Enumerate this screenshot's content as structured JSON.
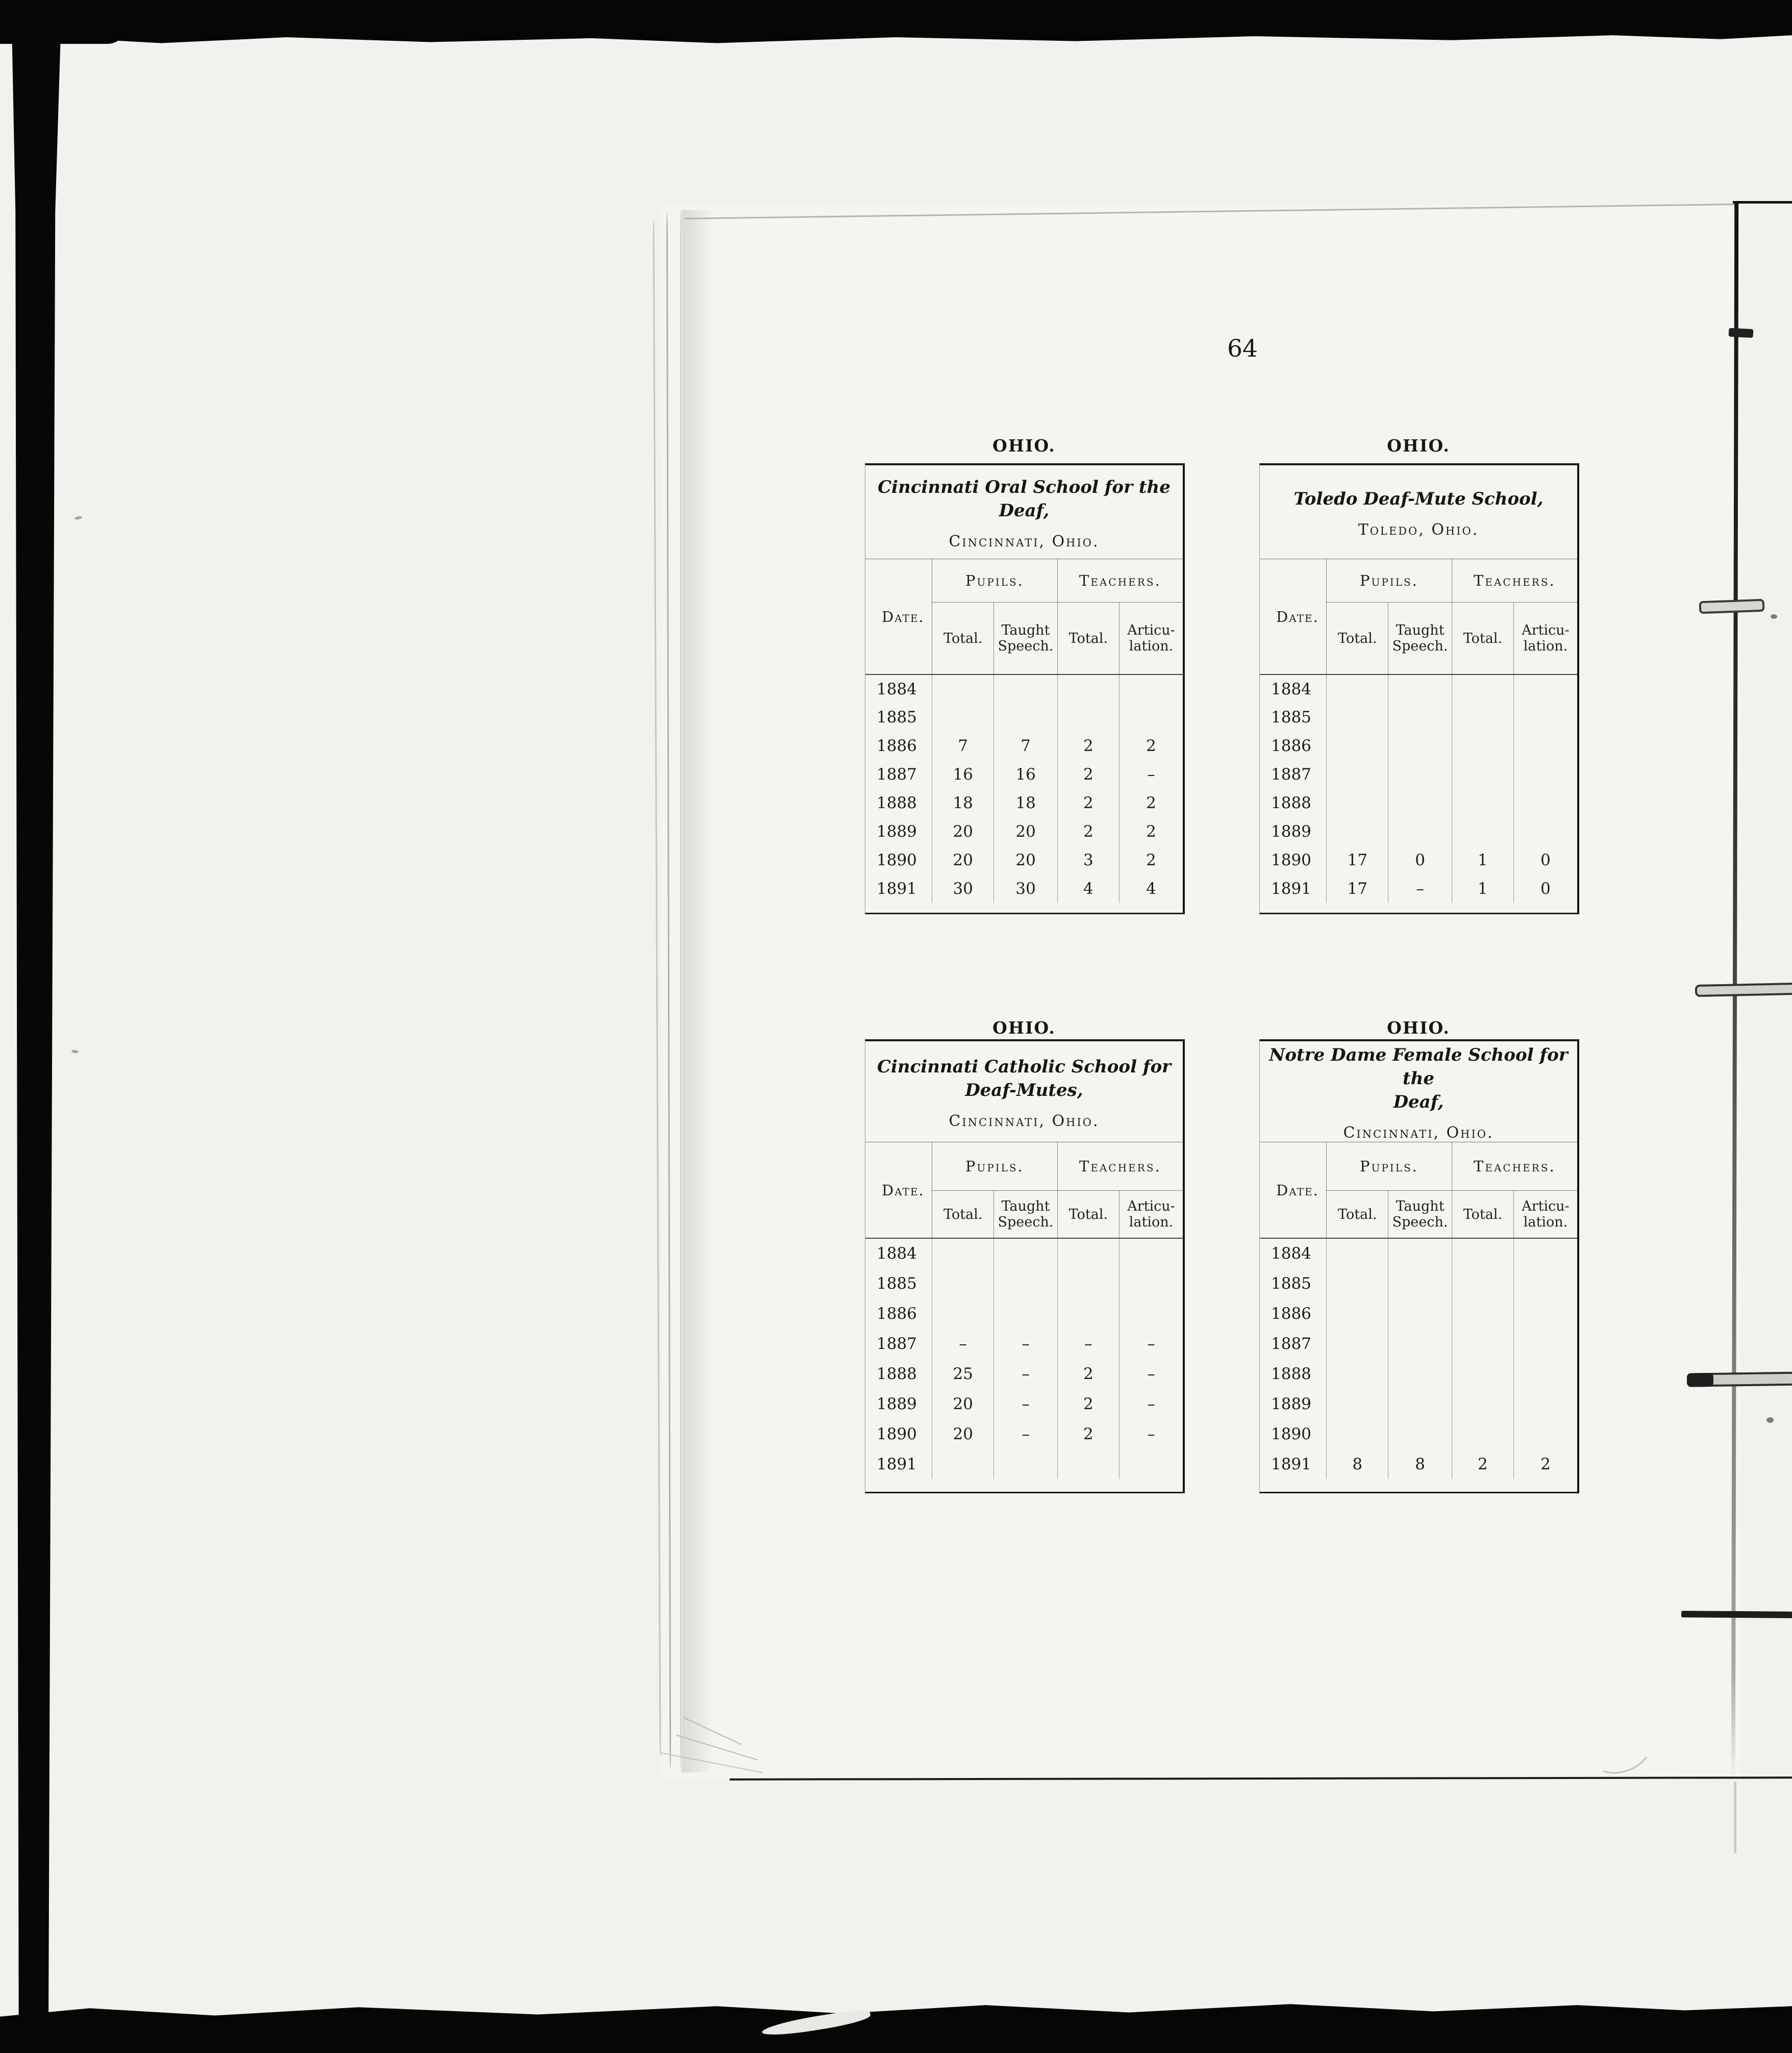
{
  "page": {
    "number": "64"
  },
  "headers": {
    "date": "Date.",
    "pupils": "Pupils.",
    "teachers": "Teachers.",
    "sub_columns": [
      "Total.",
      "Taught\nSpeech.",
      "Total.",
      "Articu-\nlation."
    ]
  },
  "tables": [
    {
      "region": "OHIO.",
      "title": "Cincinnati Oral School for the Deaf,",
      "location": "Cincinnati, Ohio.",
      "rows": [
        {
          "year": "1884",
          "values": [
            "",
            "",
            "",
            ""
          ]
        },
        {
          "year": "1885",
          "values": [
            "",
            "",
            "",
            ""
          ]
        },
        {
          "year": "1886",
          "values": [
            "7",
            "7",
            "2",
            "2"
          ]
        },
        {
          "year": "1887",
          "values": [
            "16",
            "16",
            "2",
            "–"
          ]
        },
        {
          "year": "1888",
          "values": [
            "18",
            "18",
            "2",
            "2"
          ]
        },
        {
          "year": "1889",
          "values": [
            "20",
            "20",
            "2",
            "2"
          ]
        },
        {
          "year": "1890",
          "values": [
            "20",
            "20",
            "3",
            "2"
          ]
        },
        {
          "year": "1891",
          "values": [
            "30",
            "30",
            "4",
            "4"
          ]
        }
      ]
    },
    {
      "region": "OHIO.",
      "title": "Toledo Deaf-Mute School,",
      "location": "Toledo, Ohio.",
      "rows": [
        {
          "year": "1884",
          "values": [
            "",
            "",
            "",
            ""
          ]
        },
        {
          "year": "1885",
          "values": [
            "",
            "",
            "",
            ""
          ]
        },
        {
          "year": "1886",
          "values": [
            "",
            "",
            "",
            ""
          ]
        },
        {
          "year": "1887",
          "values": [
            "",
            "",
            "",
            ""
          ]
        },
        {
          "year": "1888",
          "values": [
            "",
            "",
            "",
            ""
          ]
        },
        {
          "year": "1889",
          "values": [
            "",
            "",
            "",
            ""
          ]
        },
        {
          "year": "1890",
          "values": [
            "17",
            "0",
            "1",
            "0"
          ]
        },
        {
          "year": "1891",
          "values": [
            "17",
            "–",
            "1",
            "0"
          ]
        }
      ]
    },
    {
      "region": "OHIO.",
      "title": "Cincinnati Catholic School for\nDeaf-Mutes,",
      "location": "Cincinnati, Ohio.",
      "rows": [
        {
          "year": "1884",
          "values": [
            "",
            "",
            "",
            ""
          ]
        },
        {
          "year": "1885",
          "values": [
            "",
            "",
            "",
            ""
          ]
        },
        {
          "year": "1886",
          "values": [
            "",
            "",
            "",
            ""
          ]
        },
        {
          "year": "1887",
          "values": [
            "–",
            "–",
            "–",
            "–"
          ]
        },
        {
          "year": "1888",
          "values": [
            "25",
            "–",
            "2",
            "–"
          ]
        },
        {
          "year": "1889",
          "values": [
            "20",
            "–",
            "2",
            "–"
          ]
        },
        {
          "year": "1890",
          "values": [
            "20",
            "–",
            "2",
            "–"
          ]
        },
        {
          "year": "1891",
          "values": [
            "",
            "",
            "",
            ""
          ]
        }
      ]
    },
    {
      "region": "OHIO.",
      "title": "Notre Dame Female School for the\nDeaf,",
      "location": "Cincinnati, Ohio.",
      "rows": [
        {
          "year": "1884",
          "values": [
            "",
            "",
            "",
            ""
          ]
        },
        {
          "year": "1885",
          "values": [
            "",
            "",
            "",
            ""
          ]
        },
        {
          "year": "1886",
          "values": [
            "",
            "",
            "",
            ""
          ]
        },
        {
          "year": "1887",
          "values": [
            "",
            "",
            "",
            ""
          ]
        },
        {
          "year": "1888",
          "values": [
            "",
            "",
            "",
            ""
          ]
        },
        {
          "year": "1889",
          "values": [
            "",
            "",
            "",
            ""
          ]
        },
        {
          "year": "1890",
          "values": [
            "",
            "",
            "",
            ""
          ]
        },
        {
          "year": "1891",
          "values": [
            "8",
            "8",
            "2",
            "2"
          ]
        }
      ]
    }
  ],
  "colors": {
    "ink": "#1e1e1e",
    "paper": "#f5f4f0",
    "scan_edge": "#060606"
  }
}
